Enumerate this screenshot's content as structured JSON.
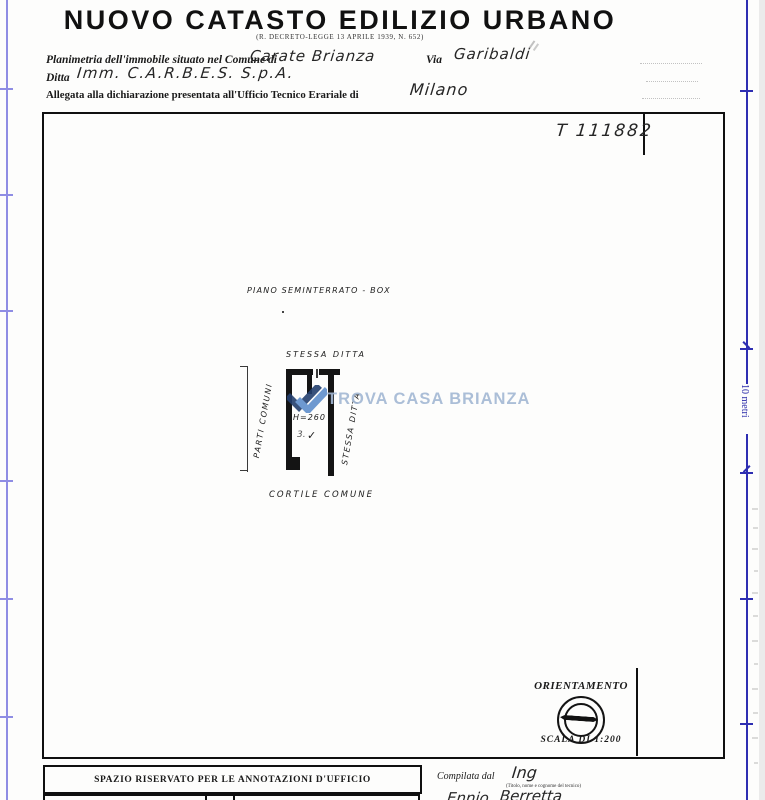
{
  "header": {
    "title": "NUOVO CATASTO EDILIZIO URBANO",
    "decree": "(R. DECRETO-LEGGE 13 APRILE 1939, N. 652)",
    "line1": {
      "label_comune": "Planimetria dell'immobile situato nel Comune di",
      "value_comune": "Carate Brianza",
      "label_via": "Via",
      "value_via": "Garibaldi"
    },
    "line2": {
      "label": "Ditta",
      "value": "Imm. C.A.R.B.E.S. S.p.A."
    },
    "line3": {
      "label": "Allegata alla dichiarazione presentata all'Ufficio Tecnico Erariale di",
      "value": "Milano"
    }
  },
  "sheet": {
    "doc_number": "T 111882",
    "floor_label": "PIANO SEMINTERRATO - BOX",
    "above_plan_label": "STESSA DITTA",
    "left_plan_label": "PARTI COMUNI",
    "right_plan_label": "STESSA DITTA",
    "below_plan_label": "CORTILE COMUNE",
    "room_height": "H=260",
    "room_number": "3.",
    "room_mark": "✓"
  },
  "orientation": {
    "title": "ORIENTAMENTO",
    "scale": "SCALA DI 1:200"
  },
  "watermark": {
    "text": "TROVA CASA BRIANZA",
    "logo_dark": "#24406f",
    "logo_light": "#5f8fcc",
    "text_color": "#a3b8d4"
  },
  "ruler": {
    "right_label": "10 metri",
    "left_color": "#8f8de4",
    "right_color": "#2e2eb2"
  },
  "footer": {
    "annotations_title": "SPAZIO RISERVATO PER LE ANNOTAZIONI D'UFFICIO",
    "compiled_label": "Compilata dal",
    "compiled_title": "Ing",
    "compiled_hint": "(Titolo, nome e cognome del tecnico)",
    "compiled_name_first": "Ennio",
    "compiled_name_last": "Berretta"
  },
  "colors": {
    "ink": "#1a1a1a",
    "paper": "#fdfdfc"
  }
}
